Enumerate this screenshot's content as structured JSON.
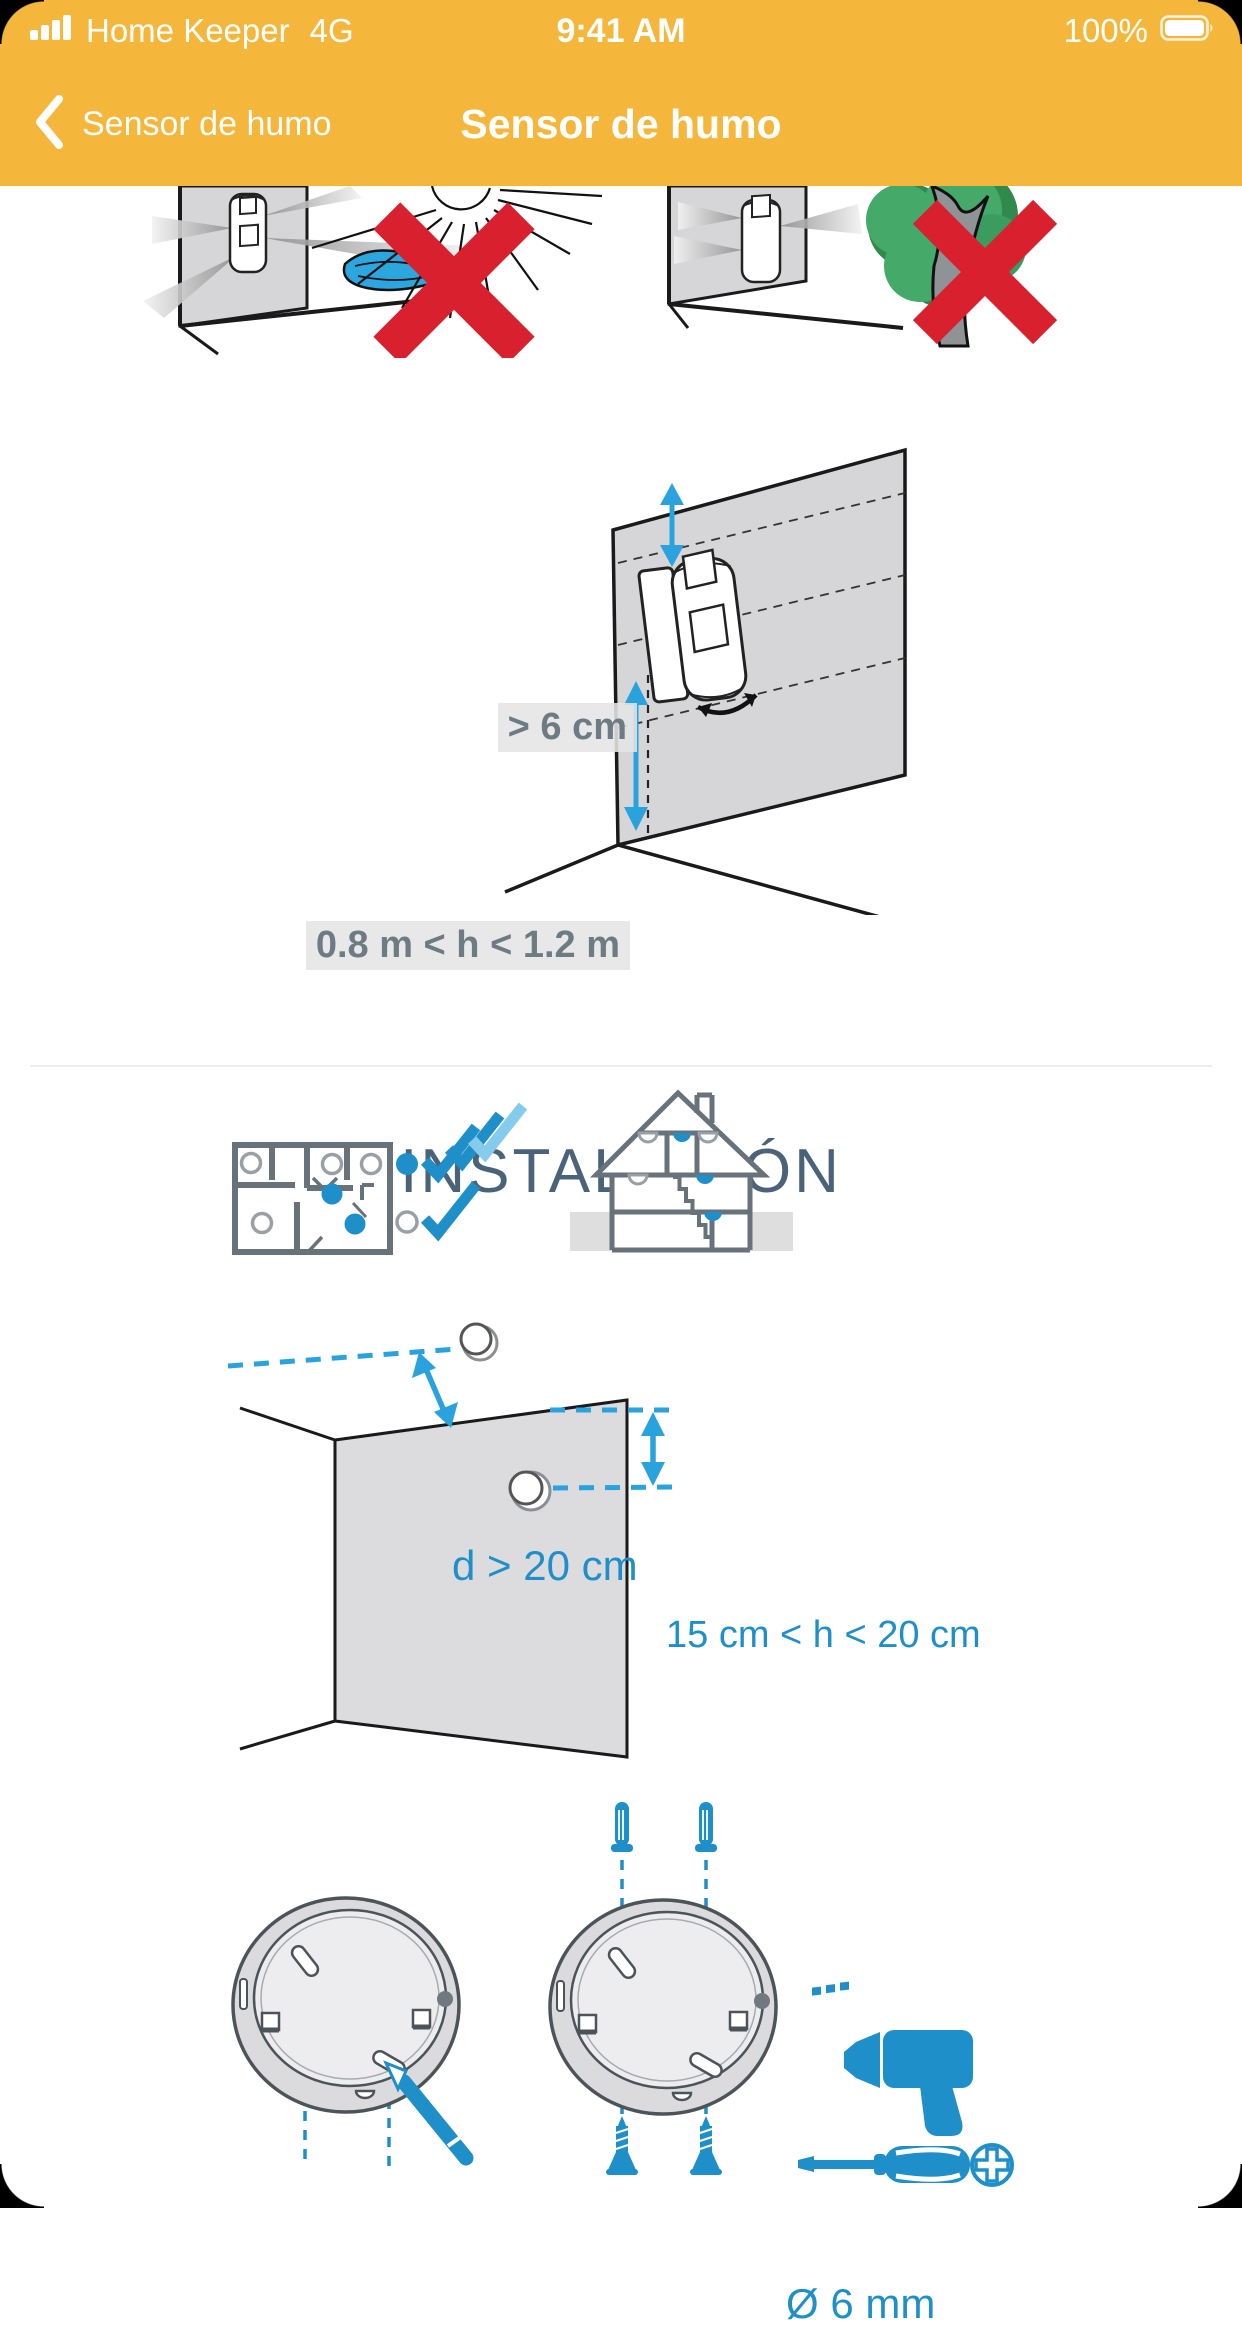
{
  "status_bar": {
    "carrier": "Home Keeper",
    "network": "4G",
    "time": "9:41 AM",
    "battery_percent": "100%"
  },
  "nav_bar": {
    "back_label": "Sensor de humo",
    "title": "Sensor de humo"
  },
  "placement_diagram": {
    "top_clearance_label": "> 6 cm",
    "height_range_label": "0.8 m < h < 1.2 m"
  },
  "installation": {
    "heading": "INSTALACIÓN",
    "ceiling_distance_label": "d > 20 cm",
    "wall_height_label": "15 cm < h < 20 cm",
    "drill_diameter_label": "Ø 6 mm"
  },
  "icons": {
    "signal": "signal-bars-icon",
    "battery": "battery-icon",
    "back": "back-chevron-icon",
    "wrong": "red-x-icon",
    "drill": "drill-icon",
    "screwdriver": "screwdriver-icon",
    "phillips": "phillips-screw-icon",
    "pencil": "pencil-icon"
  },
  "colors": {
    "header_amber": "#F5B63C",
    "accent_blue": "#1E8FC9",
    "light_blue": "#85CBEC",
    "alert_red": "#D8202F",
    "heading_text": "#4B6379",
    "measure_text": "#6D7B82",
    "outline_gray": "#68727A",
    "wall_fill": "#D6D6D8"
  }
}
